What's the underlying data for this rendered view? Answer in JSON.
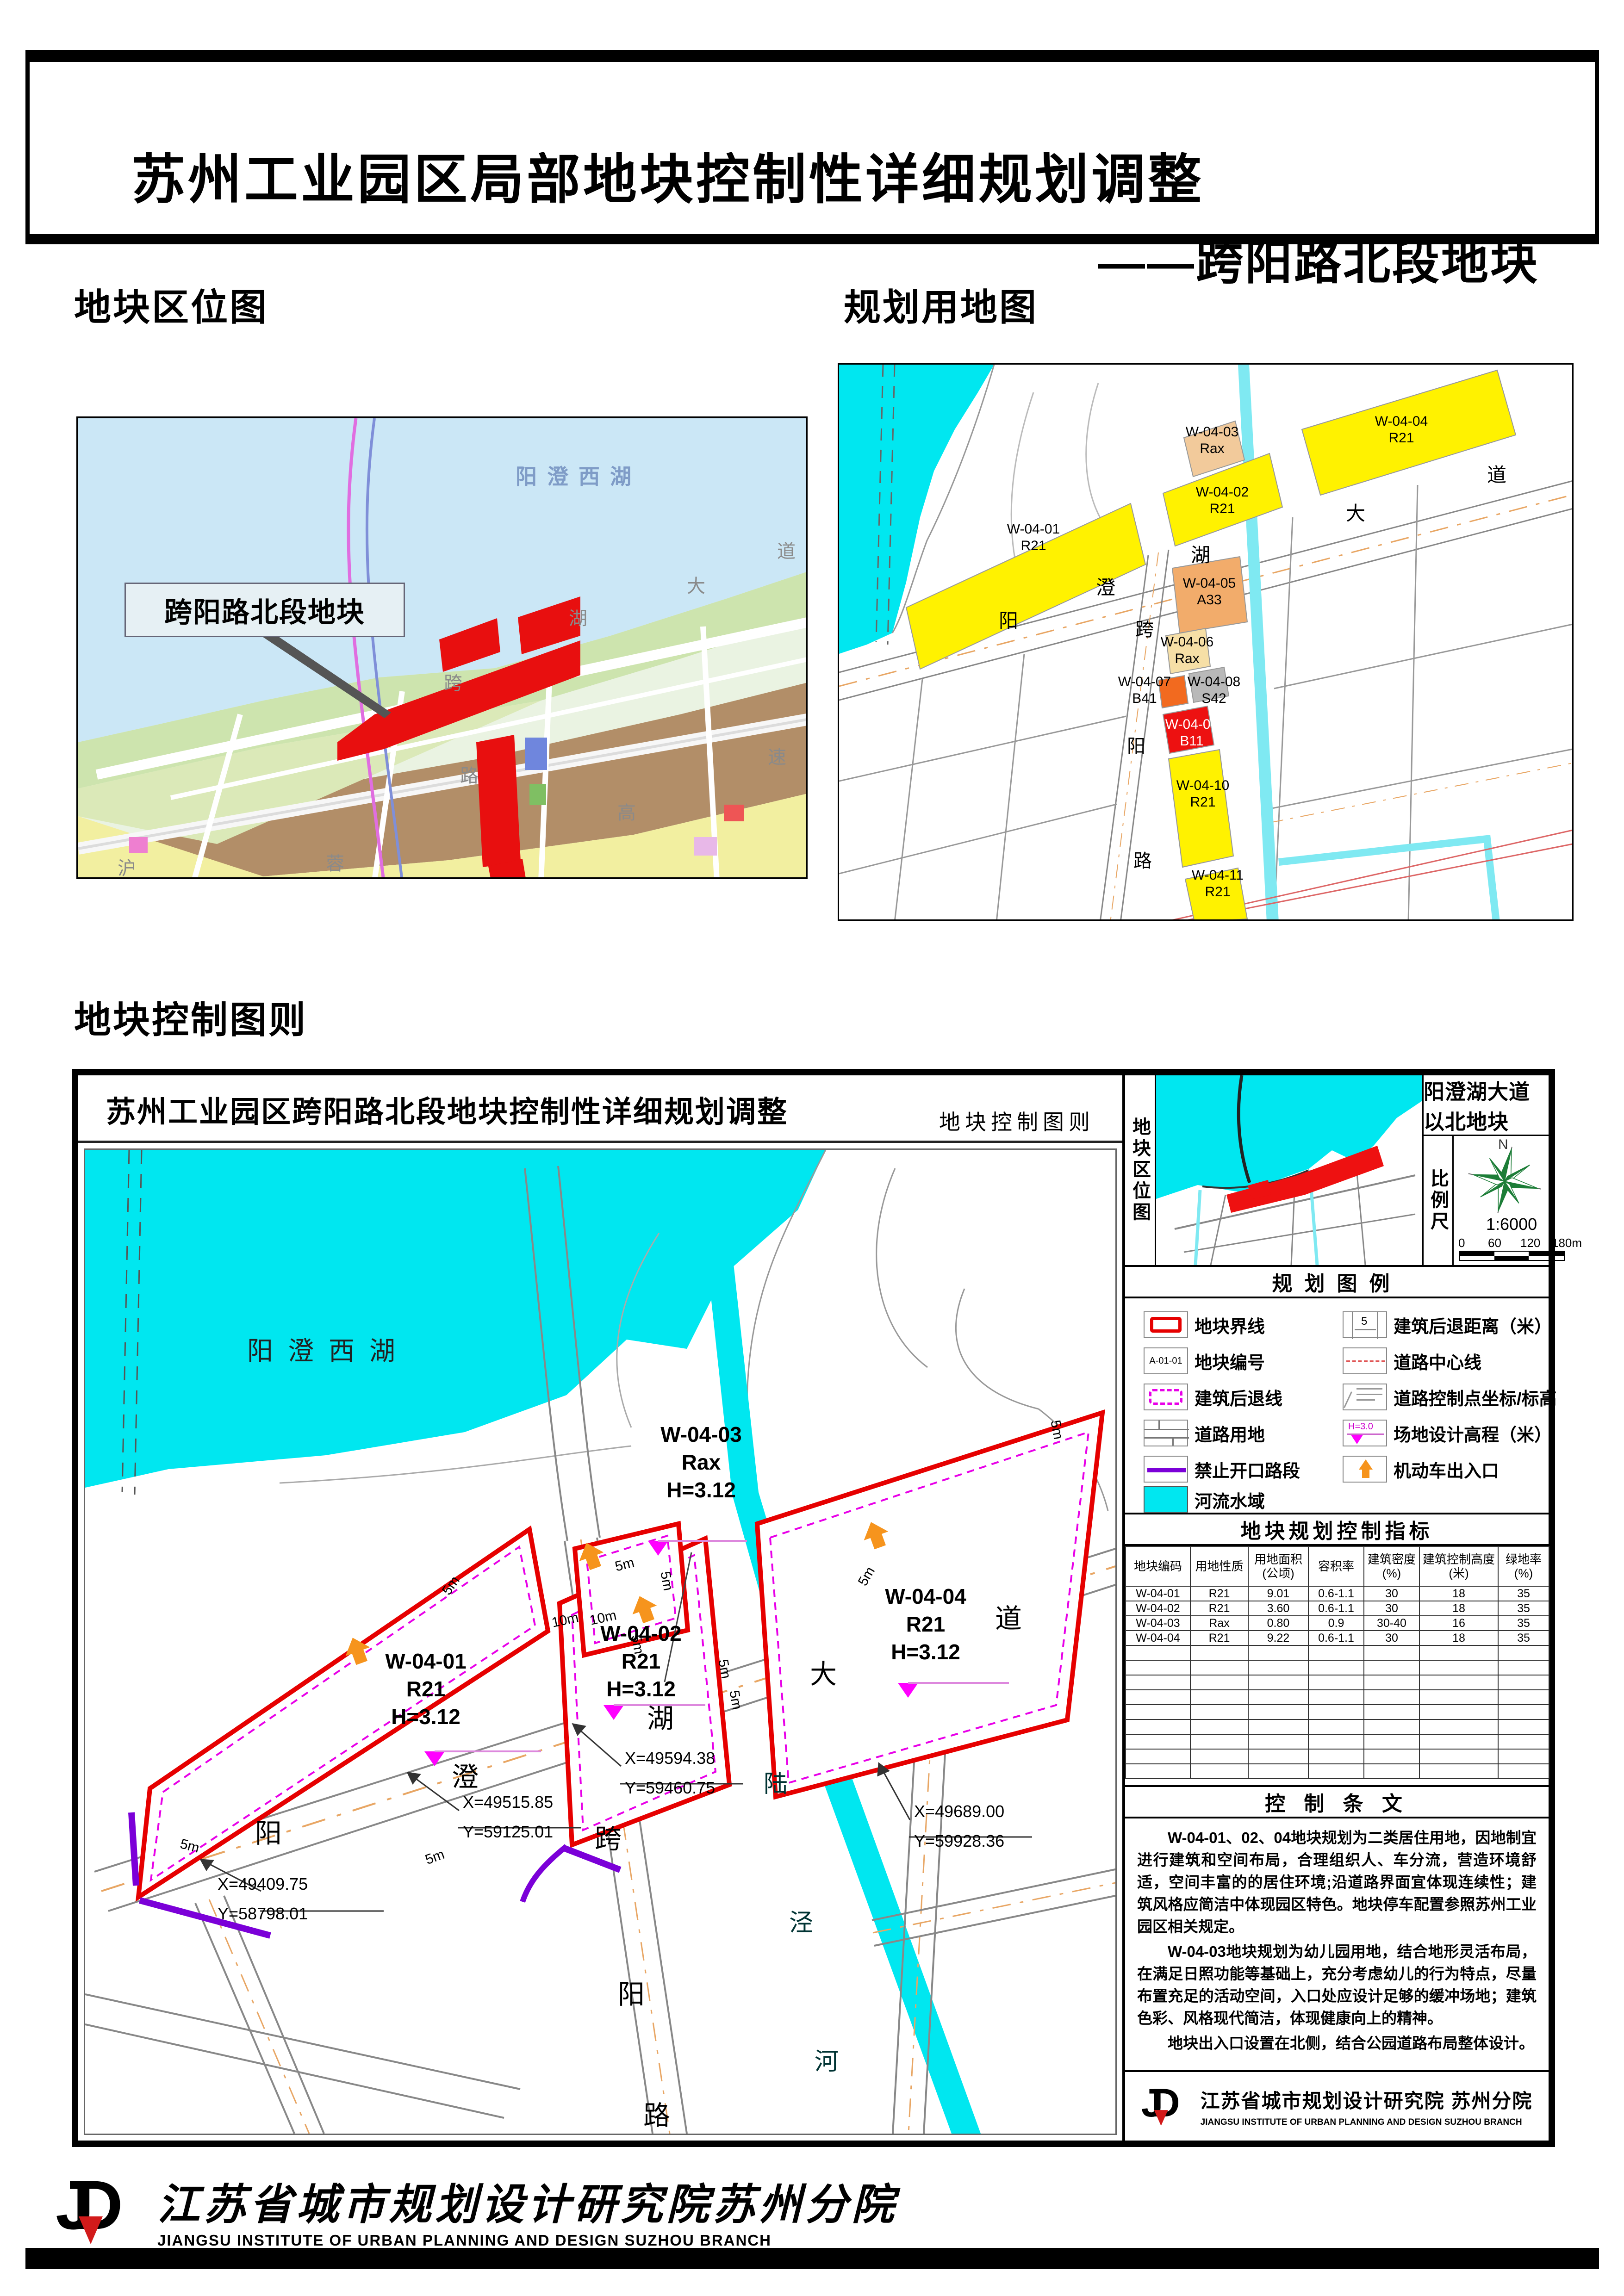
{
  "header": {
    "title": "苏州工业园区局部地块控制性详细规划调整",
    "subtitle": "——跨阳路北段地块"
  },
  "sections": {
    "location_map": "地块区位图",
    "landuse_map": "规划用地图",
    "control_chart": "地块控制图则"
  },
  "left_map": {
    "lake_label": "阳澄西湖",
    "callout": "跨阳路北段地块",
    "chars": [
      "湖",
      "大",
      "道",
      "沪",
      "蓉",
      "高",
      "速",
      "跨",
      "路"
    ]
  },
  "landuse": {
    "plots": [
      {
        "code": "W-04-01",
        "use": "R21"
      },
      {
        "code": "W-04-02",
        "use": "R21"
      },
      {
        "code": "W-04-03",
        "use": "Rax"
      },
      {
        "code": "W-04-04",
        "use": "R21"
      },
      {
        "code": "W-04-05",
        "use": "A33"
      },
      {
        "code": "W-04-06",
        "use": "Rax"
      },
      {
        "code": "W-04-07",
        "use": "B41"
      },
      {
        "code": "W-04-08",
        "use": "S42"
      },
      {
        "code": "W-04-09",
        "use": "B11"
      },
      {
        "code": "W-04-10",
        "use": "R21"
      },
      {
        "code": "W-04-11",
        "use": "R21"
      }
    ],
    "road_chars": [
      "阳",
      "澄",
      "湖",
      "大",
      "道"
    ],
    "vroad_chars": [
      "跨",
      "阳",
      "路"
    ]
  },
  "panel": {
    "title": "苏州工业园区跨阳路北段地块控制性详细规划调整",
    "subtitle": "地块控制图则",
    "sidebar": {
      "location_label": "地块区位图",
      "area_title": "阳澄湖大道以北地块",
      "scale_label": "比例尺",
      "north_label": "N",
      "scale_value": "1:6000",
      "scale_ticks": [
        "0",
        "60",
        "120",
        "180m"
      ],
      "legend_title": "规划图例",
      "legend_left": [
        {
          "label": "地块界线",
          "icon": "plot-boundary-icon"
        },
        {
          "label": "地块编号",
          "icon": "plot-code-icon"
        },
        {
          "label": "建筑后退线",
          "icon": "setback-line-icon"
        },
        {
          "label": "道路用地",
          "icon": "road-land-icon"
        },
        {
          "label": "禁止开口路段",
          "icon": "no-access-icon"
        },
        {
          "label": "河流水域",
          "icon": "water-icon"
        }
      ],
      "legend_right": [
        {
          "label": "建筑后退距离（米）",
          "icon": "setback-distance-icon"
        },
        {
          "label": "道路中心线",
          "icon": "road-centerline-icon"
        },
        {
          "label": "道路控制点坐标/标高",
          "icon": "road-control-point-icon"
        },
        {
          "label": "场地设计高程（米）",
          "icon": "site-elevation-icon"
        },
        {
          "label": "机动车出入口",
          "icon": "vehicle-entrance-icon"
        }
      ],
      "legend_plot_code": "A-01-01",
      "legend_setback_value": "5",
      "legend_elevation_value": "H=3.0",
      "indicators_title": "地块规划控制指标",
      "table": {
        "headers": [
          "地块编码",
          "用地性质",
          "用地面积\n(公顷)",
          "容积率",
          "建筑密度\n(%)",
          "建筑控制高度\n(米)",
          "绿地率\n(%)"
        ],
        "rows": [
          [
            "W-04-01",
            "R21",
            "9.01",
            "0.6-1.1",
            "30",
            "18",
            "35"
          ],
          [
            "W-04-02",
            "R21",
            "3.60",
            "0.6-1.1",
            "30",
            "18",
            "35"
          ],
          [
            "W-04-03",
            "Rax",
            "0.80",
            "0.9",
            "30-40",
            "16",
            "35"
          ],
          [
            "W-04-04",
            "R21",
            "9.22",
            "0.6-1.1",
            "30",
            "18",
            "35"
          ]
        ]
      },
      "provisions_title": "控 制 条 文",
      "provisions": [
        "W-04-01、02、04地块规划为二类居住用地，因地制宜进行建筑和空间布局，合理组织人、车分流，营造环境舒适，空间丰富的的居住环境;沿道路界面宜体现连续性；建筑风格应简洁中体现园区特色。地块停车配置参照苏州工业园区相关规定。",
        "W-04-03地块规划为幼儿园用地，结合地形灵活布局，在满足日照功能等基础上，充分考虑幼儿的行为特点，尽量布置充足的活动空间，入口处应设计足够的缓冲场地；建筑色彩、风格现代简洁，体现健康向上的精神。",
        "地块出入口设置在北侧，结合公园道路布局整体设计。"
      ],
      "institute_cn": "江苏省城市规划设计研究院 苏州分院",
      "institute_en": "JIANGSU INSTITUTE OF URBAN PLANNING AND DESIGN  SUZHOU BRANCH"
    },
    "chart": {
      "lake_chars": [
        "阳",
        "澄",
        "西",
        "湖"
      ],
      "plots": [
        {
          "code": "W-04-01",
          "use": "R21",
          "height": "H=3.12"
        },
        {
          "code": "W-04-02",
          "use": "R21",
          "height": "H=3.12"
        },
        {
          "code": "W-04-03",
          "use": "Rax",
          "height": "H=3.12"
        },
        {
          "code": "W-04-04",
          "use": "R21",
          "height": "H=3.12"
        }
      ],
      "coords": [
        {
          "x": "X=49409.75",
          "y": "Y=58798.01"
        },
        {
          "x": "X=49515.85",
          "y": "Y=59125.01"
        },
        {
          "x": "X=49594.38",
          "y": "Y=59460.75"
        },
        {
          "x": "X=49689.00",
          "y": "Y=59928.36"
        }
      ],
      "setback5": "5m",
      "setback10": "10m",
      "road_chars": [
        "阳",
        "澄",
        "湖",
        "大",
        "道"
      ],
      "kuayang_chars": [
        "跨",
        "阳",
        "路"
      ],
      "river_chars": [
        "陆",
        "泾",
        "河"
      ]
    }
  },
  "footer": {
    "institute_cn": "江苏省城市规划设计研究院苏州分院",
    "institute_en": "JIANGSU INSTITUTE OF URBAN PLANNING AND DESIGN SUZHOU BRANCH",
    "logo": "JD"
  },
  "colors": {
    "water_cyan": "#00E7F0",
    "plot_boundary_red": "#E60000",
    "setback_magenta": "#E800E8",
    "no_access_purple": "#7B00D8",
    "entrance_orange": "#F6941D",
    "residential_yellow": "#FFF200",
    "kindergarten_tan": "#F2CA9B",
    "a33_orange": "#F2AC6B",
    "b41_orange": "#F26A1F",
    "s42_gray": "#B9B9B9",
    "b11_red": "#ED1111"
  }
}
